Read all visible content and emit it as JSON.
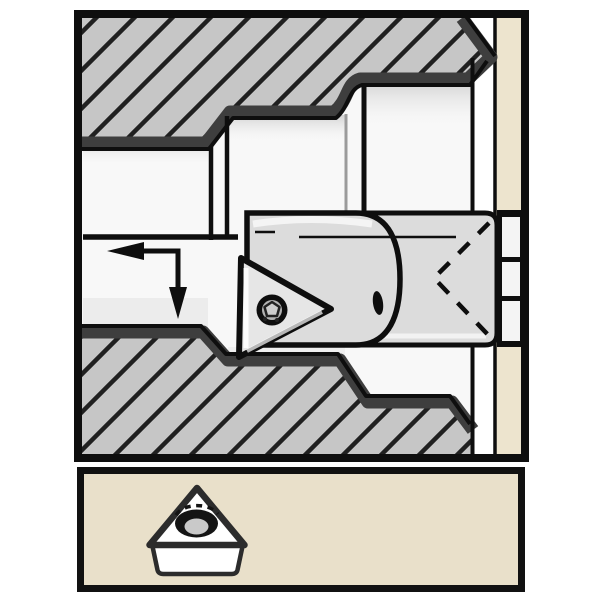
{
  "figure": {
    "type": "technical-illustration",
    "subject": "internal boring operation cross-section with indexable triangular insert",
    "panel_count": 2
  },
  "colors": {
    "page_bg": "#ffffff",
    "outline": "#0e0e0e",
    "charcoal": "#3e3e3e",
    "hatch_fill": "#c6c6c6",
    "hatch_line": "#202020",
    "bore": "#f8f8f8",
    "bore_shade_strong": "#d2d2d2",
    "bore_shade_soft": "#ececec",
    "tool_gray": "#dcdcdc",
    "insert_gray": "#e6e6e6",
    "beige_strip": "#ede4ce",
    "panel_beige": "#e9e0ca",
    "white": "#ffffff",
    "detail_outline": "#2c2c2c",
    "hole_inner_gray": "#c9c9c9",
    "screw_ring_gray": "#b3b3b3",
    "screw_face_gray": "#cdcdcd",
    "box_white": "#f4f4f4",
    "highlight": "#f4f4f4",
    "step_line_gray": "#9b9b9b"
  },
  "main_panel": {
    "name": "boring-operation-cross-section",
    "parts": {
      "workpiece": "hatched-section",
      "tool": "boring-bar",
      "insert": "triangular-insert",
      "screw": "insert-clamp-screw",
      "arrow": "feed-direction-arrow",
      "arrow_directions": [
        "left",
        "down"
      ],
      "right_side": "machine-face-and-clamp"
    }
  },
  "detail_panel": {
    "name": "insert-detail",
    "parts": {
      "insert": "triangular-insert-3d",
      "hole": "insert-center-hole"
    }
  }
}
